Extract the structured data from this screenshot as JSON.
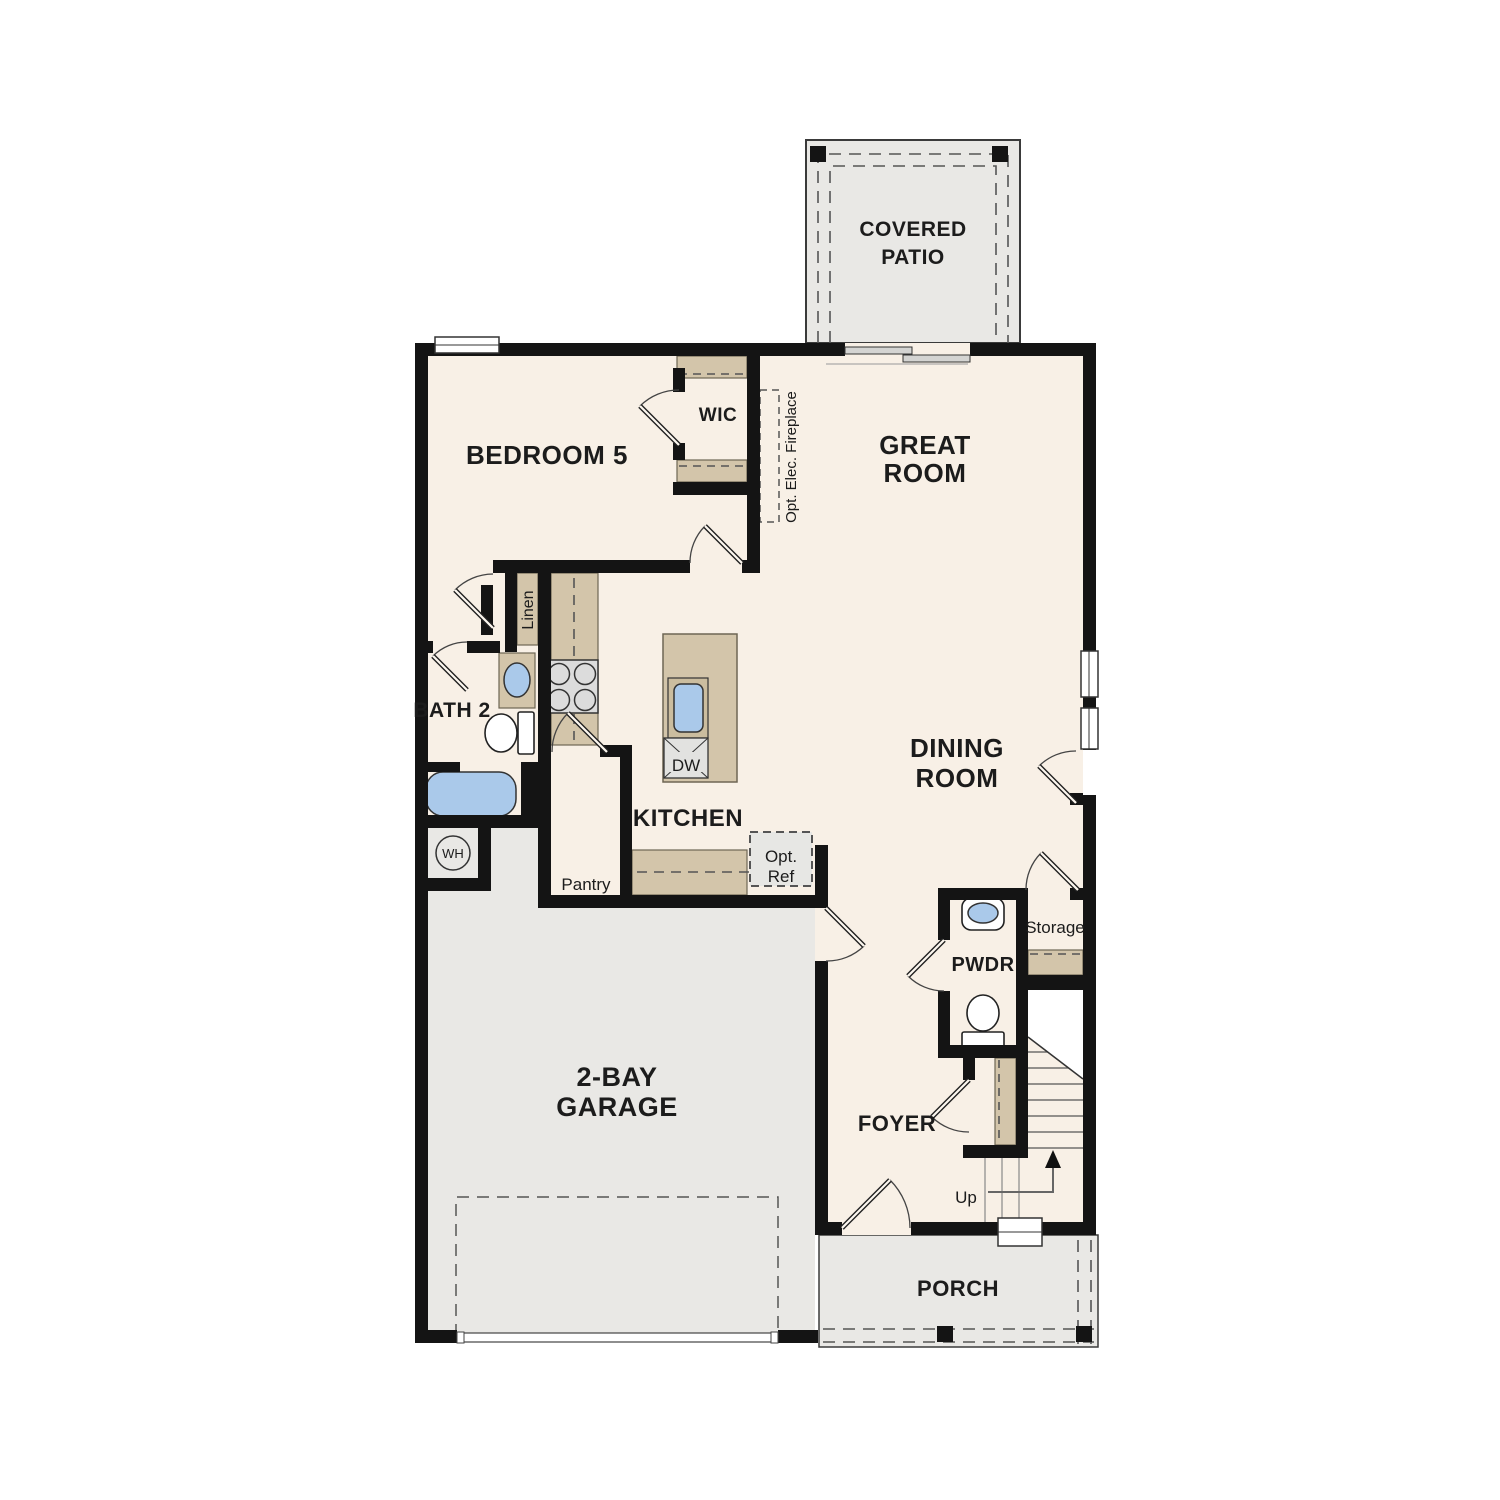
{
  "plan": {
    "name": "first-floor-plan"
  },
  "colors": {
    "floor": "#f8f0e6",
    "outdoor": "#e9e8e5",
    "wall": "#141414",
    "cabinet": "#d3c5aa",
    "fixture_blue": "#aac9ea"
  },
  "rooms": {
    "covered_patio": {
      "line1": "COVERED",
      "line2": "PATIO"
    },
    "bedroom_5": {
      "label": "BEDROOM 5"
    },
    "wic": {
      "label": "WIC"
    },
    "great_room": {
      "line1": "GREAT",
      "line2": "ROOM"
    },
    "bath_2": {
      "label": "BATH 2"
    },
    "kitchen": {
      "label": "KITCHEN"
    },
    "dining_room": {
      "line1": "DINING",
      "line2": "ROOM"
    },
    "garage": {
      "line1": "2-BAY",
      "line2": "GARAGE"
    },
    "pwdr": {
      "label": "PWDR"
    },
    "storage": {
      "label": "Storage"
    },
    "foyer": {
      "label": "FOYER"
    },
    "porch": {
      "label": "PORCH"
    }
  },
  "features": {
    "fireplace": "Opt. Elec. Fireplace",
    "linen": "Linen",
    "pantry": "Pantry",
    "opt_ref": {
      "line1": "Opt.",
      "line2": "Ref"
    },
    "water_heater": "WH",
    "dishwasher": "DW",
    "stairs": "Up"
  }
}
